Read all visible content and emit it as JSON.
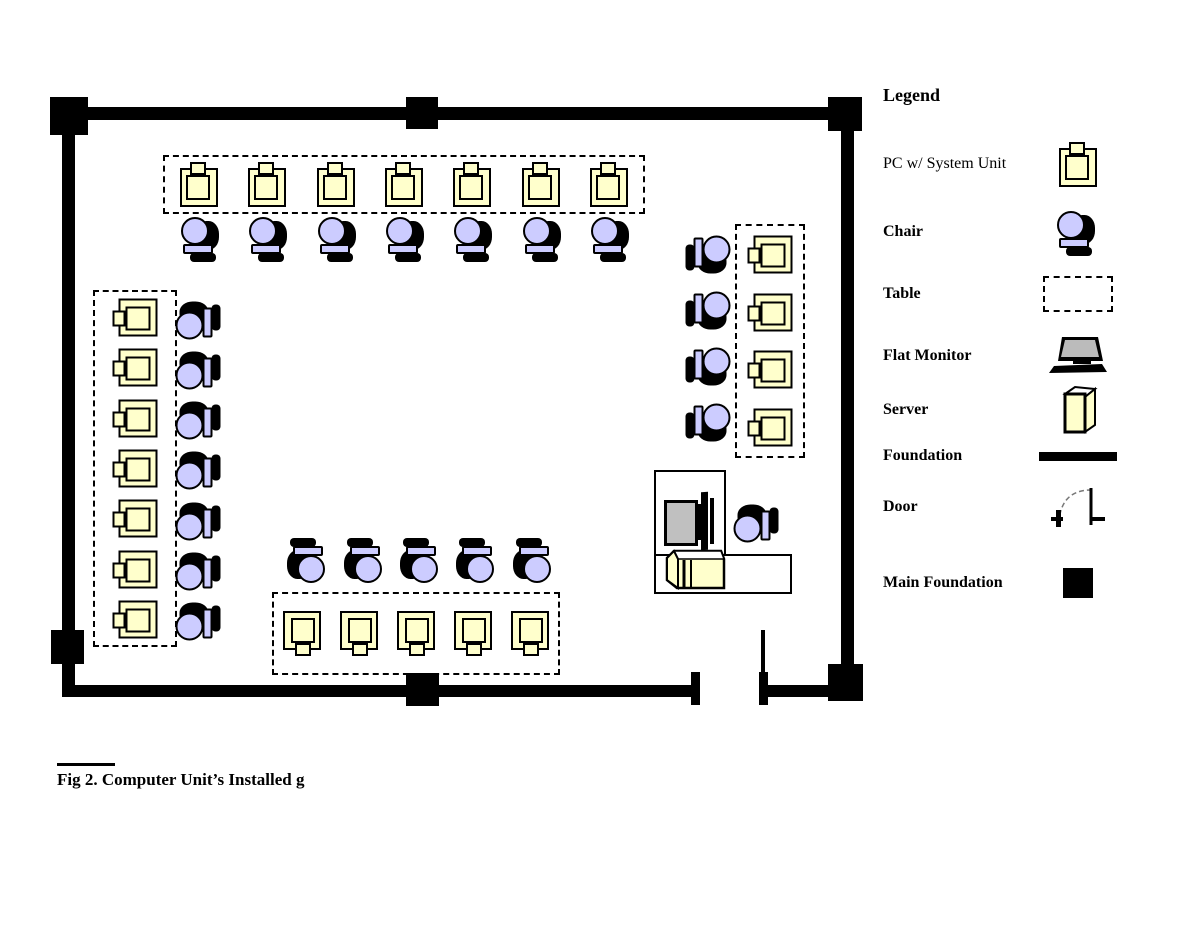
{
  "legend": {
    "title": "Legend",
    "items": [
      {
        "label": "PC w/ System Unit",
        "icon": "pc-icon"
      },
      {
        "label": "Chair",
        "icon": "chair-icon"
      },
      {
        "label": "Table",
        "icon": "table-icon"
      },
      {
        "label": "Flat Monitor",
        "icon": "flat-monitor-icon"
      },
      {
        "label": "Server",
        "icon": "server-icon"
      },
      {
        "label": "Foundation",
        "icon": "foundation-icon"
      },
      {
        "label": "Door",
        "icon": "door-icon"
      },
      {
        "label": "Main Foundation",
        "icon": "main-foundation-icon"
      }
    ]
  },
  "caption": "Fig 2. Computer Unit’s Installed g",
  "floorplan": {
    "groups": [
      {
        "name": "top",
        "pcs": 7,
        "chairs": 7
      },
      {
        "name": "left",
        "pcs": 7,
        "chairs": 7
      },
      {
        "name": "right",
        "pcs": 4,
        "chairs": 4
      },
      {
        "name": "bottom",
        "pcs": 5,
        "chairs": 5
      }
    ],
    "instructor_station": {
      "flat_monitors": 1,
      "servers": 1,
      "chairs": 1,
      "desks": 2
    },
    "totals": {
      "student_pcs": 23,
      "student_chairs": 23,
      "main_foundation_blocks": 6,
      "doors": 1
    },
    "colors": {
      "pc_fill": "#FFFFCC",
      "chair_fill": "#CCCCFF",
      "monitor_screen": "#C0C0C0",
      "wall": "#000000"
    }
  }
}
